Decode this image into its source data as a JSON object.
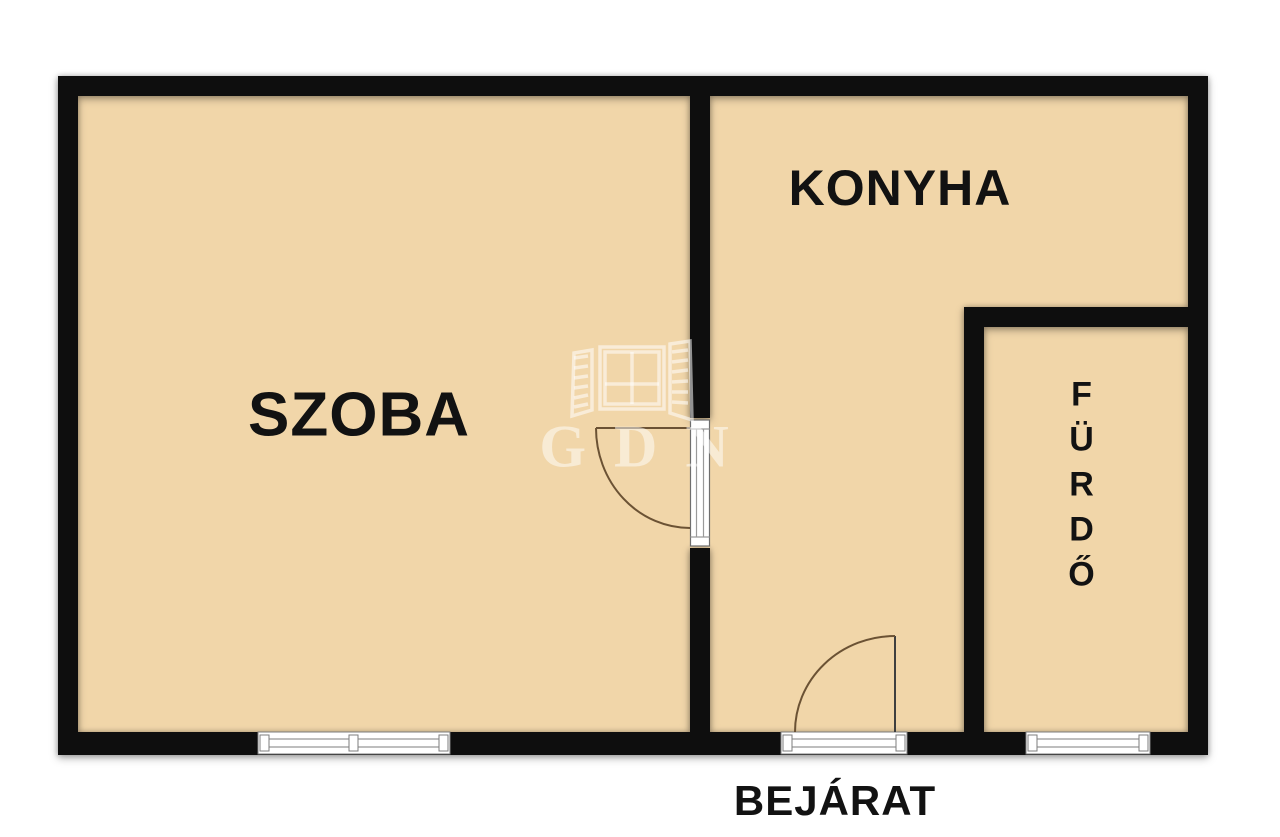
{
  "plan_title": "apartment-floor-plan",
  "rooms": {
    "szoba": {
      "label": "SZOBA"
    },
    "konyha": {
      "label": "KONYHA"
    },
    "furdo": {
      "label": "FÜRDŐ"
    }
  },
  "entrance": {
    "label": "BEJÁRAT"
  },
  "watermark": {
    "text": "GDN",
    "icon": "window-icon"
  },
  "colors": {
    "background": "#ffffff",
    "floor": "#f1d6a9",
    "wall": "#0e0e0e",
    "door_arc": "#6b5234",
    "door_leaf": "#3f3f3f",
    "window_frame": "#7d7d7d",
    "label_text": "#121212",
    "watermark": "rgba(255,255,255,0.5)"
  }
}
